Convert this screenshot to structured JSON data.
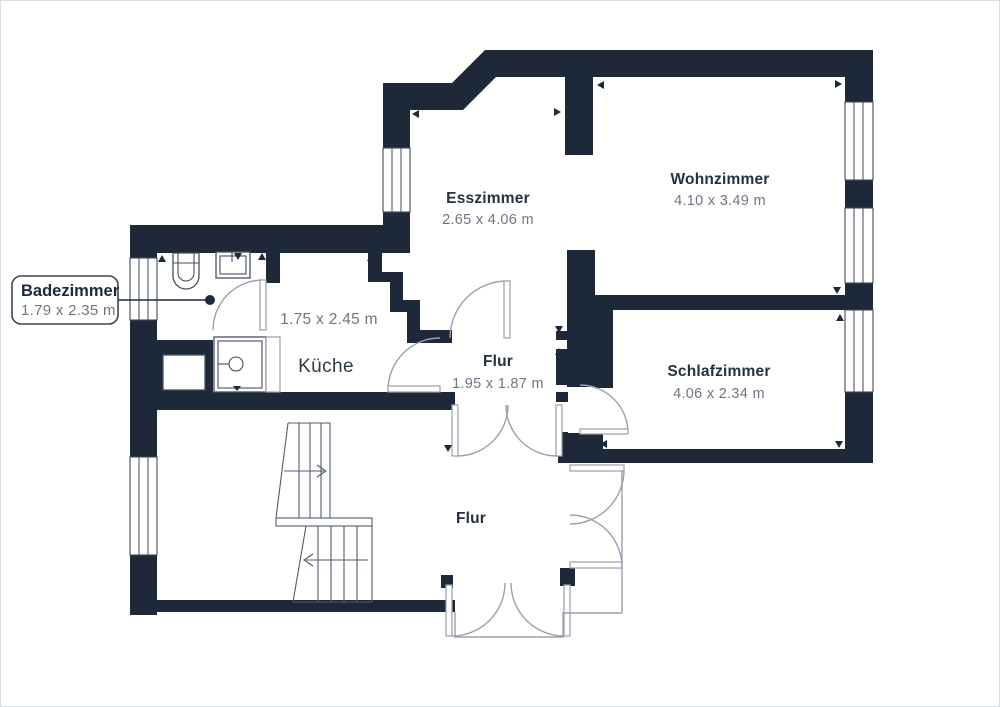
{
  "colors": {
    "wall": "#1D2939",
    "background": "#ffffff",
    "canvas_border": "#d9dde3",
    "door_line": "#9aa0ab",
    "room_name_text": "#26313f",
    "dimension_text": "#6e7683"
  },
  "rooms": {
    "esszimmer": {
      "name": "Esszimmer",
      "dims": "2.65 x 4.06 m"
    },
    "wohnzimmer": {
      "name": "Wohnzimmer",
      "dims": "4.10 x 3.49 m"
    },
    "kueche": {
      "name": "Küche",
      "dims": "1.75 x 2.45 m"
    },
    "flur": {
      "name": "Flur",
      "dims": "1.95 x 1.87 m"
    },
    "schlafzimmer": {
      "name": "Schlafzimmer",
      "dims": "4.06 x 2.34 m"
    },
    "flur_unten": {
      "name": "Flur"
    }
  },
  "callout": {
    "name": "Badezimmer",
    "dims": "1.79 x 2.35 m"
  }
}
